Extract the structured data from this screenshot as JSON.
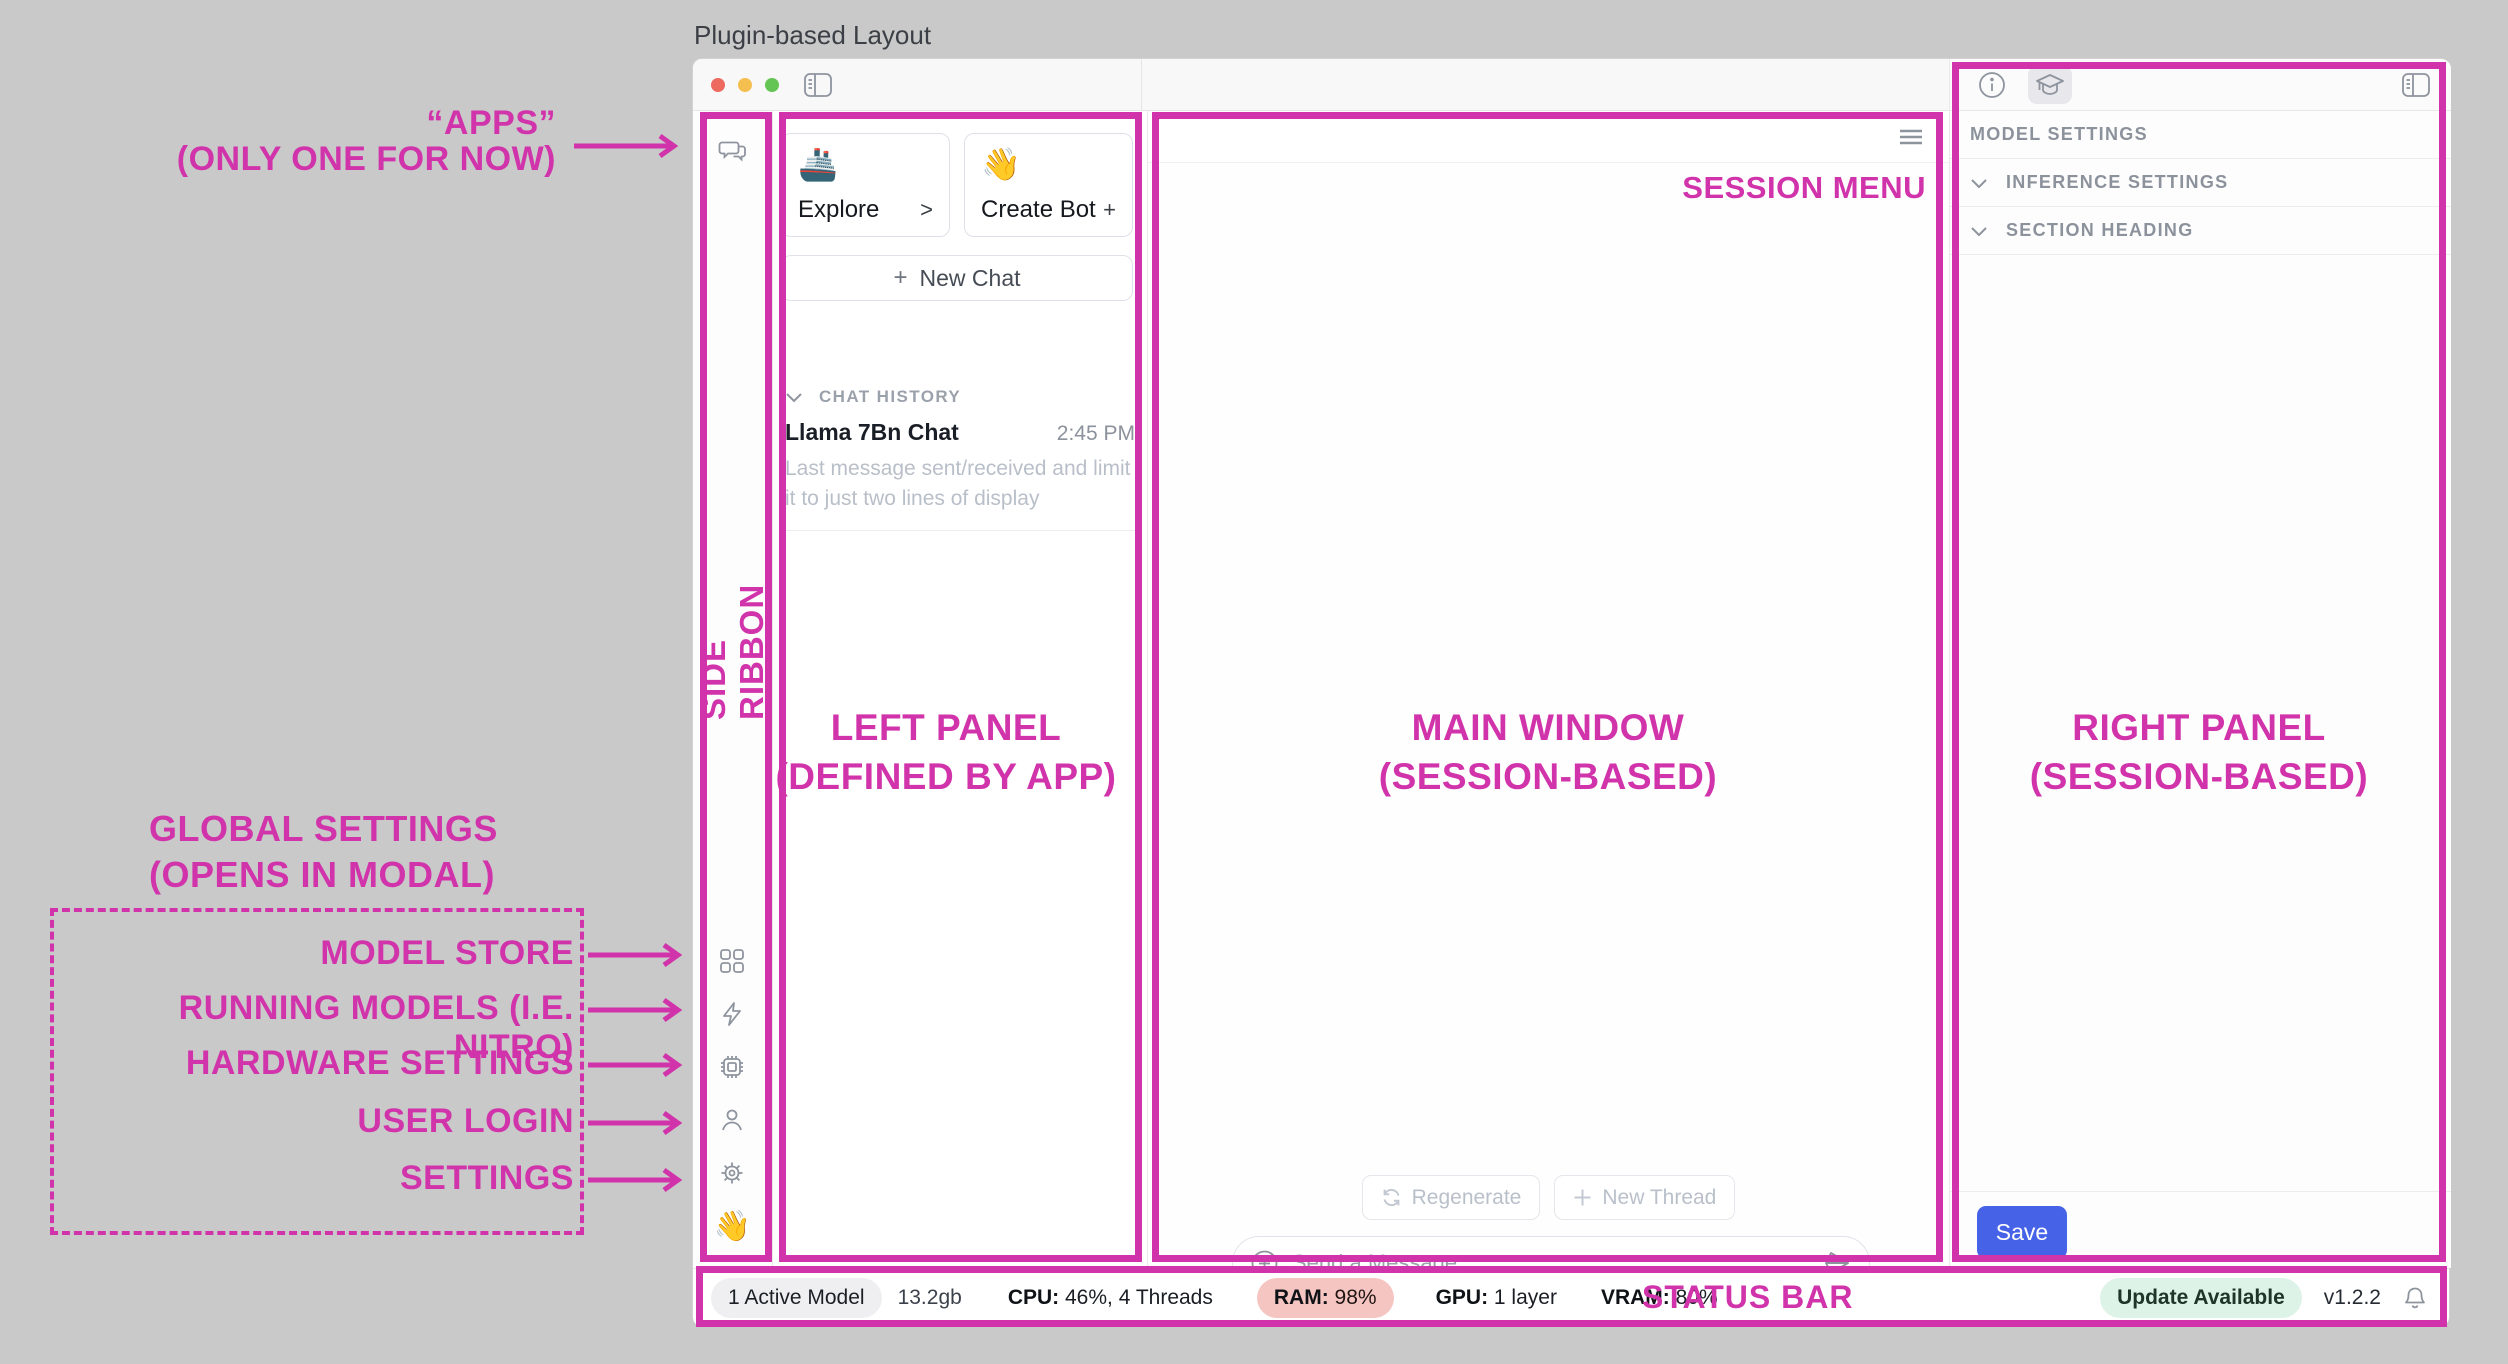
{
  "page": {
    "title": "Plugin-based Layout"
  },
  "annotations": {
    "accent_color": "#d133ab",
    "apps": {
      "line1": "“APPS”",
      "line2": "(ONLY ONE FOR NOW)"
    },
    "side_ribbon": "SIDE RIBBON",
    "left_panel": {
      "line1": "LEFT PANEL",
      "line2": "(DEFINED BY APP)"
    },
    "main_window": {
      "line1": "MAIN WINDOW",
      "line2": "(SESSION-BASED)"
    },
    "right_panel": {
      "line1": "RIGHT PANEL",
      "line2": "(SESSION-BASED)"
    },
    "session_menu": "SESSION MENU",
    "status_bar": "STATUS BAR",
    "global_settings": {
      "line1": "GLOBAL SETTINGS",
      "line2": "(OPENS IN MODAL)"
    },
    "ribbon_items": {
      "model_store": "MODEL STORE",
      "running_models": "RUNNING MODELS (I.E. NITRO)",
      "hardware_settings": "HARDWARE SETTINGS",
      "user_login": "USER LOGIN",
      "settings": "SETTINGS"
    }
  },
  "left_panel": {
    "cards": [
      {
        "emoji": "🚢",
        "label": "Explore",
        "affix": ">"
      },
      {
        "emoji": "👋",
        "label": "Create Bot",
        "affix": "+"
      }
    ],
    "new_chat": {
      "plus": "+",
      "label": "New Chat"
    },
    "chat_history": {
      "heading": "CHAT HISTORY",
      "items": [
        {
          "title": "Llama 7Bn Chat",
          "time": "2:45 PM",
          "preview": "Last message sent/received and limit it to just two lines of display"
        }
      ]
    }
  },
  "ribbon": {
    "hand_emoji": "👋"
  },
  "main": {
    "regenerate_label": "Regenerate",
    "new_thread_label": "New Thread",
    "composer_placeholder": "Send a Message"
  },
  "right_panel": {
    "heading": "MODEL SETTINGS",
    "row_inference": "INFERENCE SETTINGS",
    "row_section": "SECTION HEADING",
    "save_label": "Save"
  },
  "status_bar": {
    "active_models": "1 Active Model",
    "size": "13.2gb",
    "cpu_label": "CPU:",
    "cpu_value": " 46%, 4 Threads",
    "ram_label": "RAM:",
    "ram_value": " 98%",
    "gpu_label": "GPU:",
    "gpu_value": " 1 layer",
    "vram_label": "VRAM:",
    "vram_value": " 80%",
    "update": "Update Available",
    "version": "v1.2.2"
  }
}
